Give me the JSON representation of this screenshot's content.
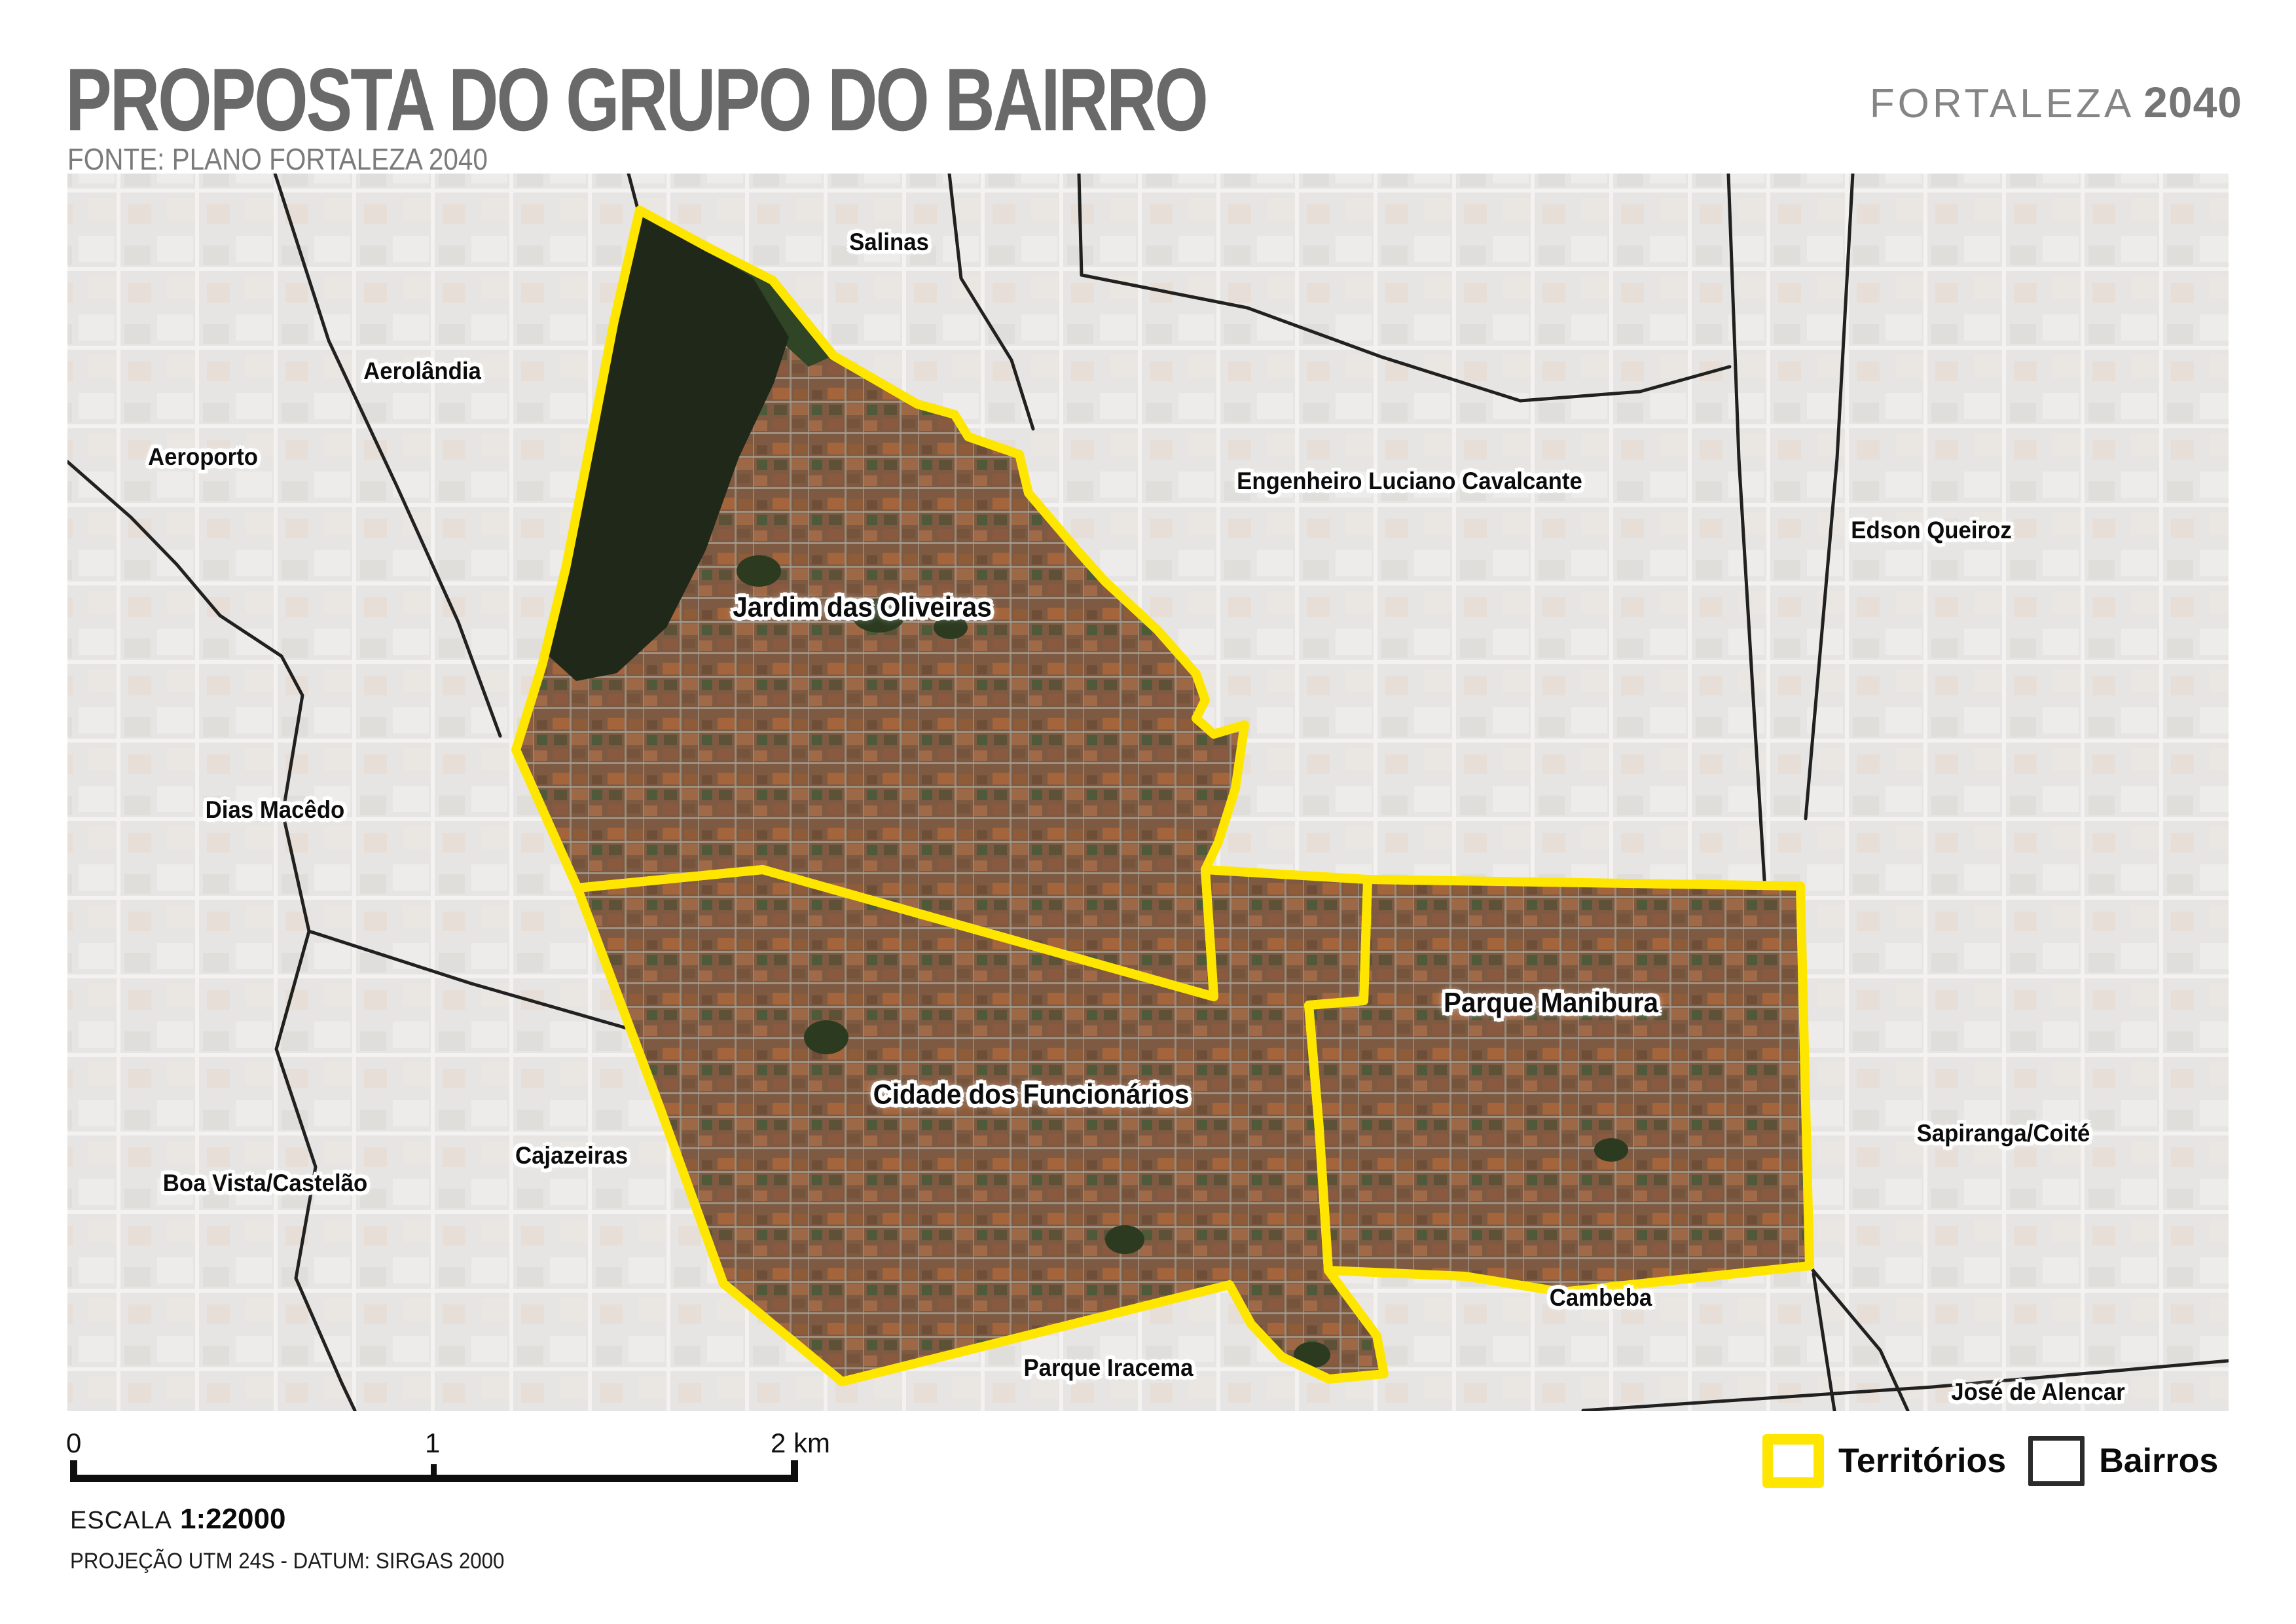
{
  "header": {
    "title": "PROPOSTA DO GRUPO DO BAIRRO",
    "source": "FONTE: PLANO FORTALEZA 2040",
    "logo": {
      "name": "FORTALEZA",
      "year": "2040"
    }
  },
  "map": {
    "territory_labels": [
      "Jardim das Oliveiras",
      "Cidade dos Funcionários",
      "Parque Manibura"
    ],
    "bairro_labels": [
      "Salinas",
      "Aerolândia",
      "Aeroporto",
      "Engenheiro Luciano Cavalcante",
      "Edson Queiroz",
      "Dias Macêdo",
      "Cajazeiras",
      "Boa Vista/Castelão",
      "Sapiranga/Coité",
      "Cambeba",
      "Parque Iracema",
      "José de Alencar"
    ]
  },
  "footer": {
    "scalebar_ticks": [
      "0",
      "1",
      "2 km"
    ],
    "scale_label": "ESCALA",
    "scale_value": "1:22000",
    "projection": "PROJEÇÃO UTM 24S - DATUM: SIRGAS 2000"
  },
  "legend": {
    "territories_label": "Territórios",
    "bairros_label": "Bairros"
  },
  "colors": {
    "territory_outline": "#FFE600",
    "bairro_outline": "#161616",
    "title_gray": "#696969"
  }
}
